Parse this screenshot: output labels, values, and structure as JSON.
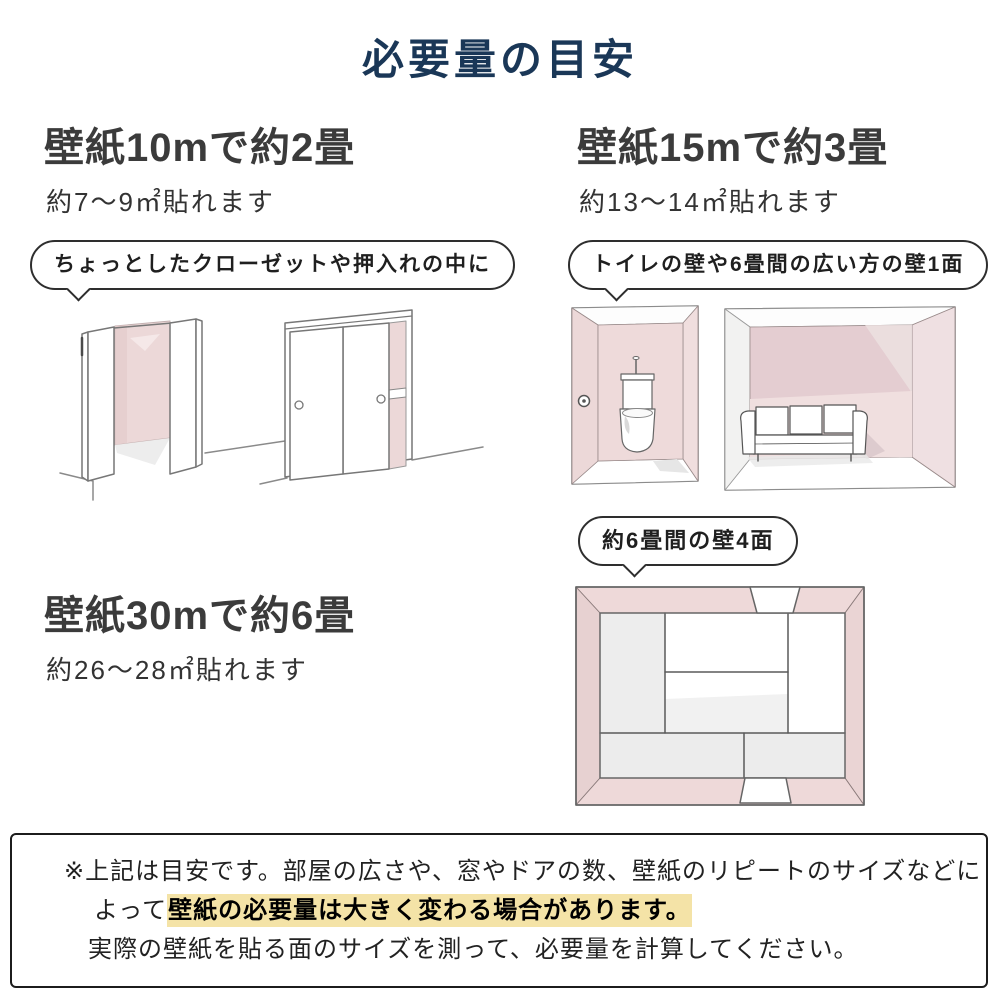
{
  "title": "必要量の目安",
  "colors": {
    "accent_navy": "#1a3757",
    "wall_pink": "#ecd8d8",
    "highlight_yellow": "#f4e3a7"
  },
  "sections": {
    "s10": {
      "heading": "壁紙10mで約2畳",
      "sub": "約7〜9㎡貼れます",
      "bubble": "ちょっとしたクローゼットや押入れの中に",
      "illustrations": [
        "open-closet",
        "sliding-door-closet"
      ]
    },
    "s15": {
      "heading": "壁紙15mで約3畳",
      "sub": "約13〜14㎡貼れます",
      "bubble": "トイレの壁や6畳間の広い方の壁1面",
      "illustrations": [
        "toilet-room",
        "sofa-room"
      ]
    },
    "s30": {
      "heading": "壁紙30mで約6畳",
      "sub": "約26〜28㎡貼れます",
      "bubble": "約6畳間の壁4面",
      "illustrations": [
        "tatami-room-top-view"
      ]
    }
  },
  "note": {
    "line1": "※上記は目安です。部屋の広さや、窓やドアの数、壁紙のリピートのサイズなどに",
    "line2_prefix": "よって",
    "line2_highlight": "壁紙の必要量は大きく変わる場合があります。",
    "line3": "実際の壁紙を貼る面のサイズを測って、必要量を計算してください。"
  }
}
